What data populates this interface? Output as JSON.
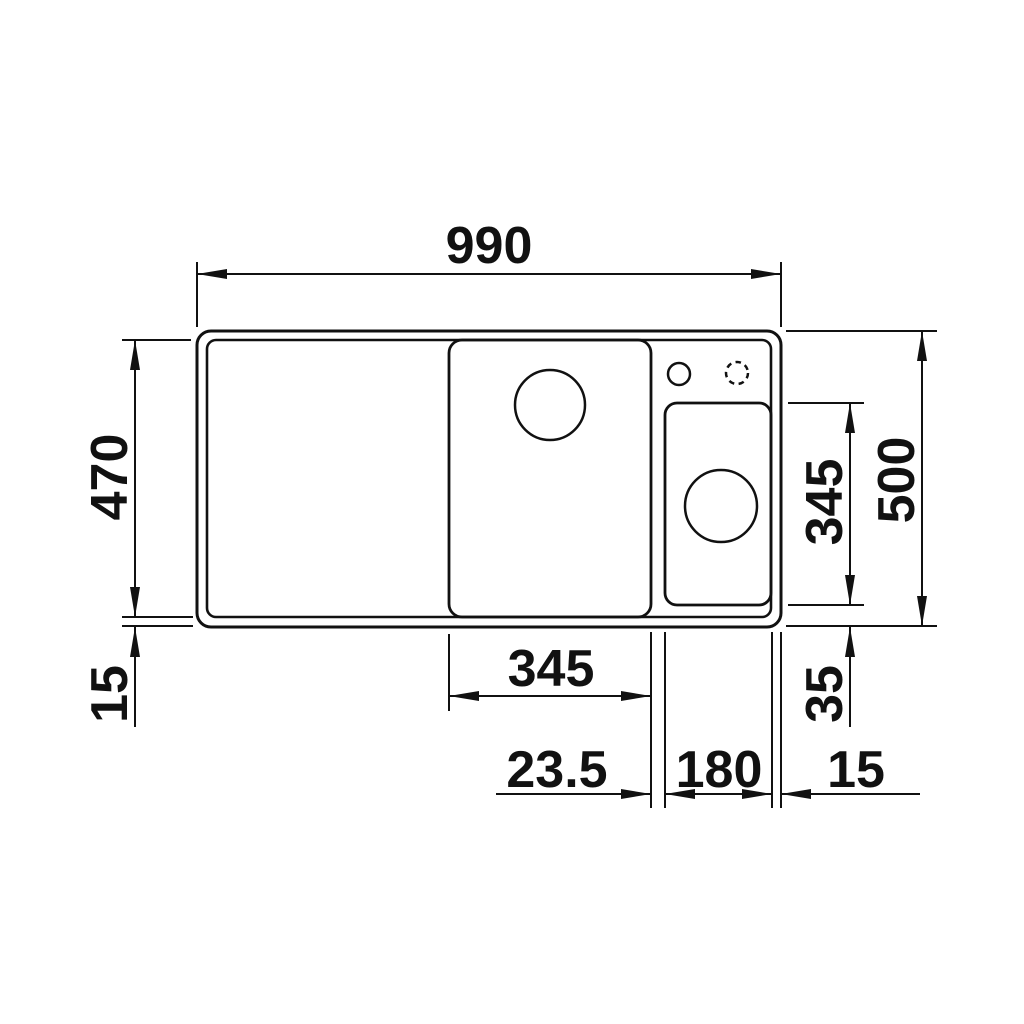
{
  "drawing": {
    "type": "technical-dimension-drawing",
    "subject": "kitchen sink top view with half bowl, drainboard and tap holes",
    "units": "mm",
    "colors": {
      "background": "#ffffff",
      "line": "#111111"
    },
    "labels": {
      "overall_width": "990",
      "overall_depth": "500",
      "inner_depth": "470",
      "rim_bottom_left": "15",
      "half_bowl_length": "345",
      "half_bowl_bottom_offset": "35",
      "main_bowl_width": "345",
      "bowl_gap": "23.5",
      "half_bowl_width": "180",
      "rim_right": "15"
    }
  }
}
